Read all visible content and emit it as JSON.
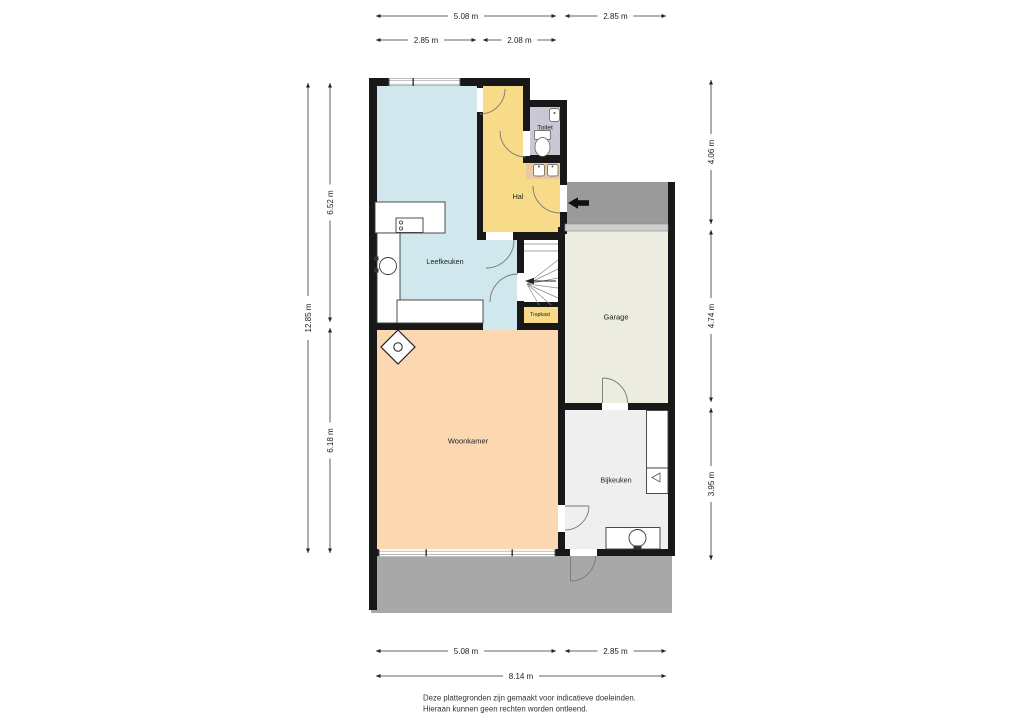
{
  "footer": {
    "line1": "Deze plattegronden zijn gemaakt voor indicatieve doeleinden.",
    "line2": "Hieraan kunnen geen rechten worden ontleend."
  },
  "rooms": {
    "toilet": "Toilet",
    "hal": "Hal",
    "leefkeuken": "Leefkeuken",
    "trapkast": "Trapkast",
    "garage": "Garage",
    "woonkamer": "Woonkamer",
    "bijkeuken": "Bijkeuken"
  },
  "dimensions": {
    "top_outer": [
      "5.08 m",
      "2.85 m"
    ],
    "top_inner": [
      "2.85 m",
      "2.08 m"
    ],
    "left_total": "12.85 m",
    "left_inner": [
      "6.52 m",
      "6.18 m"
    ],
    "right": [
      "4.06 m",
      "4.74 m",
      "3.95 m"
    ],
    "bottom_outer": [
      "5.08 m",
      "2.85 m"
    ],
    "bottom_total": "8.14 m"
  },
  "colors": {
    "leefkeuken": "#cfe7ed",
    "hal": "#f7db88",
    "trapkast": "#f7db88",
    "toilet": "#c9c9d5",
    "vanity": "#e8c9a2",
    "garage": "#ecece0",
    "woonkamer": "#fbd7b2",
    "bijkeuken": "#efefef",
    "porch": "#9a9a9a",
    "terrace": "#a8a8a8",
    "garage_door": "#cfcfcf",
    "wall": "#181818",
    "entrance_arrow": "#111111"
  },
  "icons": {
    "entrance_arrow": "entrance-direction",
    "stairs_arrow": "stairs-direction"
  }
}
